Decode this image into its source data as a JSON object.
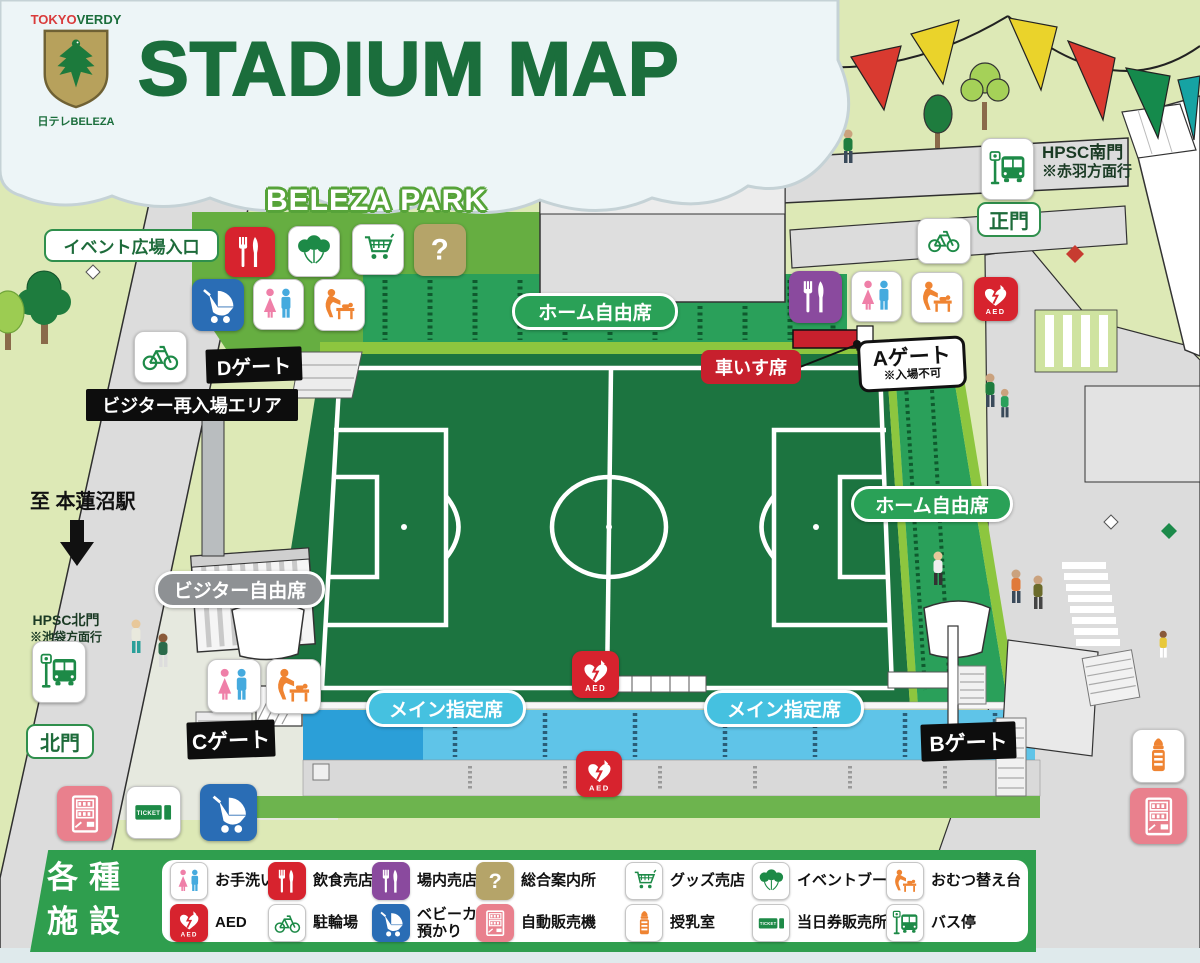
{
  "header": {
    "logo_tokyo": "TOKYO",
    "logo_verdy": "VERDY",
    "logo_beleza": "日テレBELEZA",
    "title": "STADIUM MAP"
  },
  "park": {
    "name": "BELEZA PARK"
  },
  "labels": {
    "event_plaza_entrance": "イベント広場入口",
    "gate_d": "Dゲート",
    "visitor_reentry_area": "ビジター再入場エリア",
    "wheelchair_seats": "車いす席",
    "gate_a": "Aゲート",
    "gate_a_note": "※入場不可",
    "home_free_seats_north": "ホーム自由席",
    "home_free_seats_east": "ホーム自由席",
    "visitor_free_seats": "ビジター自由席",
    "main_reserved_seats_left": "メイン指定席",
    "main_reserved_seats_right": "メイン指定席",
    "gate_c": "Cゲート",
    "gate_b": "Bゲート",
    "north_gate": "北門",
    "main_gate": "正門",
    "hpsc_south_gate": "HPSC南門",
    "hpsc_south_note": "※赤羽方面行",
    "hpsc_north_gate": "HPSC北門",
    "hpsc_north_note": "※池袋方面行",
    "to_station": "至 本蓮沼駅"
  },
  "legend": {
    "title_line1": "各種",
    "title_line2": "施設",
    "aed_text": "AED",
    "ticket_text": "TICKET",
    "info_glyph": "?",
    "items": [
      {
        "label": "お手洗い",
        "icon": "restroom-icon"
      },
      {
        "label": "飲食売店",
        "icon": "food-stall-icon"
      },
      {
        "label": "場内売店",
        "icon": "stadium-shop-icon"
      },
      {
        "label": "総合案内所",
        "icon": "information-icon"
      },
      {
        "label": "グッズ売店",
        "icon": "goods-shop-icon"
      },
      {
        "label": "イベントブース",
        "icon": "event-booth-icon"
      },
      {
        "label": "おむつ替え台",
        "icon": "diaper-change-icon"
      },
      {
        "label": "AED",
        "icon": "aed-icon"
      },
      {
        "label": "駐輪場",
        "icon": "bicycle-parking-icon"
      },
      {
        "label": "ベビーカー預かり",
        "icon": "stroller-check-icon"
      },
      {
        "label": "自動販売機",
        "icon": "vending-machine-icon"
      },
      {
        "label": "授乳室",
        "icon": "nursing-room-icon"
      },
      {
        "label": "当日券販売所",
        "icon": "ticket-office-icon"
      },
      {
        "label": "バス停",
        "icon": "bus-stop-icon"
      }
    ]
  },
  "colors": {
    "brand_green": "#1b6e3c",
    "stand_green": "#2aa05a",
    "pitch_green": "#1c7440",
    "seat_blue": "#5fc4e8",
    "label_cyan": "#45c1e0",
    "label_gray": "#8e9194",
    "signal_red": "#d7232e",
    "shop_purple": "#8a4a9e",
    "icon_green": "#1d8a47",
    "icon_orange": "#ef8432",
    "info_tan": "#b5a469",
    "vending_pink": "#e9808d",
    "stroller_blue": "#2a6db5",
    "legend_green": "#2f9e4e"
  }
}
